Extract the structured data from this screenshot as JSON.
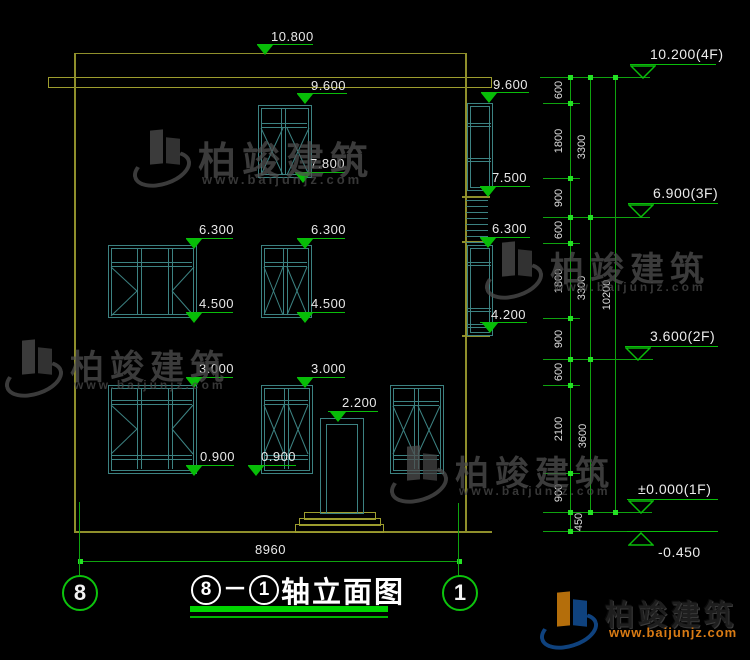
{
  "drawing": {
    "title": {
      "axis_start": "8",
      "separator": "－",
      "axis_end": "1",
      "name": "轴立面图"
    },
    "bottom_dimension": "8960",
    "axis_bubbles": [
      {
        "label": "8"
      },
      {
        "label": "1"
      }
    ],
    "colors": {
      "wall": "#8f8f2b",
      "window_frame": "#3c8282",
      "dimension": "#0fa30f",
      "bright_tick": "#24e224",
      "text": "#e8e8e8",
      "title_underline": "#00d400"
    },
    "elevation_markers": [
      {
        "label": "10.800",
        "line": [
          257,
          56,
          44
        ],
        "tri": 257,
        "text": [
          271,
          30
        ]
      },
      {
        "label": "9.600",
        "line": [
          297,
          50,
          93
        ],
        "tri": 297,
        "text": [
          311,
          79
        ]
      },
      {
        "label": "7.800",
        "line": [
          295,
          50,
          172
        ],
        "tri": 295,
        "text": [
          310,
          157
        ]
      },
      {
        "label": "9.600",
        "line": [
          481,
          48,
          92
        ],
        "tri": 481,
        "text": [
          493,
          78
        ]
      },
      {
        "label": "7.500",
        "line": [
          480,
          50,
          186
        ],
        "tri": 480,
        "text": [
          492,
          171
        ]
      },
      {
        "label": "6.300",
        "line": [
          480,
          50,
          237
        ],
        "tri": 480,
        "text": [
          492,
          222
        ]
      },
      {
        "label": "4.200",
        "line": [
          480,
          47,
          322
        ],
        "tri": 482,
        "text": [
          491,
          308
        ]
      },
      {
        "label": "6.300",
        "line": [
          186,
          47,
          238
        ],
        "tri": 186,
        "text": [
          199,
          223
        ]
      },
      {
        "label": "6.300",
        "line": [
          297,
          48,
          238
        ],
        "tri": 297,
        "text": [
          311,
          223
        ]
      },
      {
        "label": "4.500",
        "line": [
          186,
          47,
          312
        ],
        "tri": 186,
        "text": [
          199,
          297
        ]
      },
      {
        "label": "4.500",
        "line": [
          297,
          48,
          312
        ],
        "tri": 297,
        "text": [
          311,
          297
        ]
      },
      {
        "label": "3.000",
        "line": [
          186,
          47,
          377
        ],
        "tri": 186,
        "text": [
          199,
          362
        ]
      },
      {
        "label": "3.000",
        "line": [
          297,
          48,
          377
        ],
        "tri": 297,
        "text": [
          311,
          362
        ]
      },
      {
        "label": "2.200",
        "line": [
          328,
          50,
          411
        ],
        "tri": 330,
        "text": [
          342,
          396
        ]
      },
      {
        "label": "0.900",
        "line": [
          186,
          48,
          465
        ],
        "tri": 186,
        "text": [
          200,
          450
        ]
      },
      {
        "label": "0.900",
        "line": [
          248,
          48,
          465
        ],
        "tri": 248,
        "text": [
          261,
          450
        ]
      }
    ],
    "floor_markers": [
      {
        "label": "10.200(4F)",
        "line": [
          630,
          86,
          64
        ],
        "apex": 643,
        "up": false,
        "text": [
          650,
          47
        ]
      },
      {
        "label": "6.900(3F)",
        "line": [
          628,
          90,
          203
        ],
        "apex": 641,
        "up": false,
        "text": [
          653,
          186
        ]
      },
      {
        "label": "3.600(2F)",
        "line": [
          625,
          93,
          346
        ],
        "apex": 638,
        "up": false,
        "text": [
          650,
          329
        ]
      },
      {
        "label": "±0.000(1F)",
        "line": [
          627,
          91,
          499
        ],
        "apex": 641,
        "up": false,
        "text": [
          638,
          482
        ]
      },
      {
        "label": "-0.450",
        "line": [
          627,
          91,
          531
        ],
        "apex": 641,
        "up": true,
        "text": [
          658,
          545
        ]
      }
    ],
    "segment_dimensions": [
      {
        "label": "600",
        "x": 559,
        "y": 90
      },
      {
        "label": "1800",
        "x": 559,
        "y": 141
      },
      {
        "label": "900",
        "x": 559,
        "y": 198
      },
      {
        "label": "600",
        "x": 559,
        "y": 230
      },
      {
        "label": "1800",
        "x": 559,
        "y": 281
      },
      {
        "label": "900",
        "x": 559,
        "y": 339
      },
      {
        "label": "600",
        "x": 559,
        "y": 372
      },
      {
        "label": "2100",
        "x": 559,
        "y": 429
      },
      {
        "label": "900",
        "x": 559,
        "y": 493
      },
      {
        "label": "450",
        "x": 579,
        "y": 522
      },
      {
        "label": "3300",
        "x": 582,
        "y": 147
      },
      {
        "label": "3300",
        "x": 582,
        "y": 288
      },
      {
        "label": "3600",
        "x": 583,
        "y": 436
      },
      {
        "label": "10200",
        "x": 607,
        "y": 295
      }
    ]
  },
  "watermark": {
    "brand": "柏竣建筑",
    "url": "www.baijunjz.com"
  }
}
